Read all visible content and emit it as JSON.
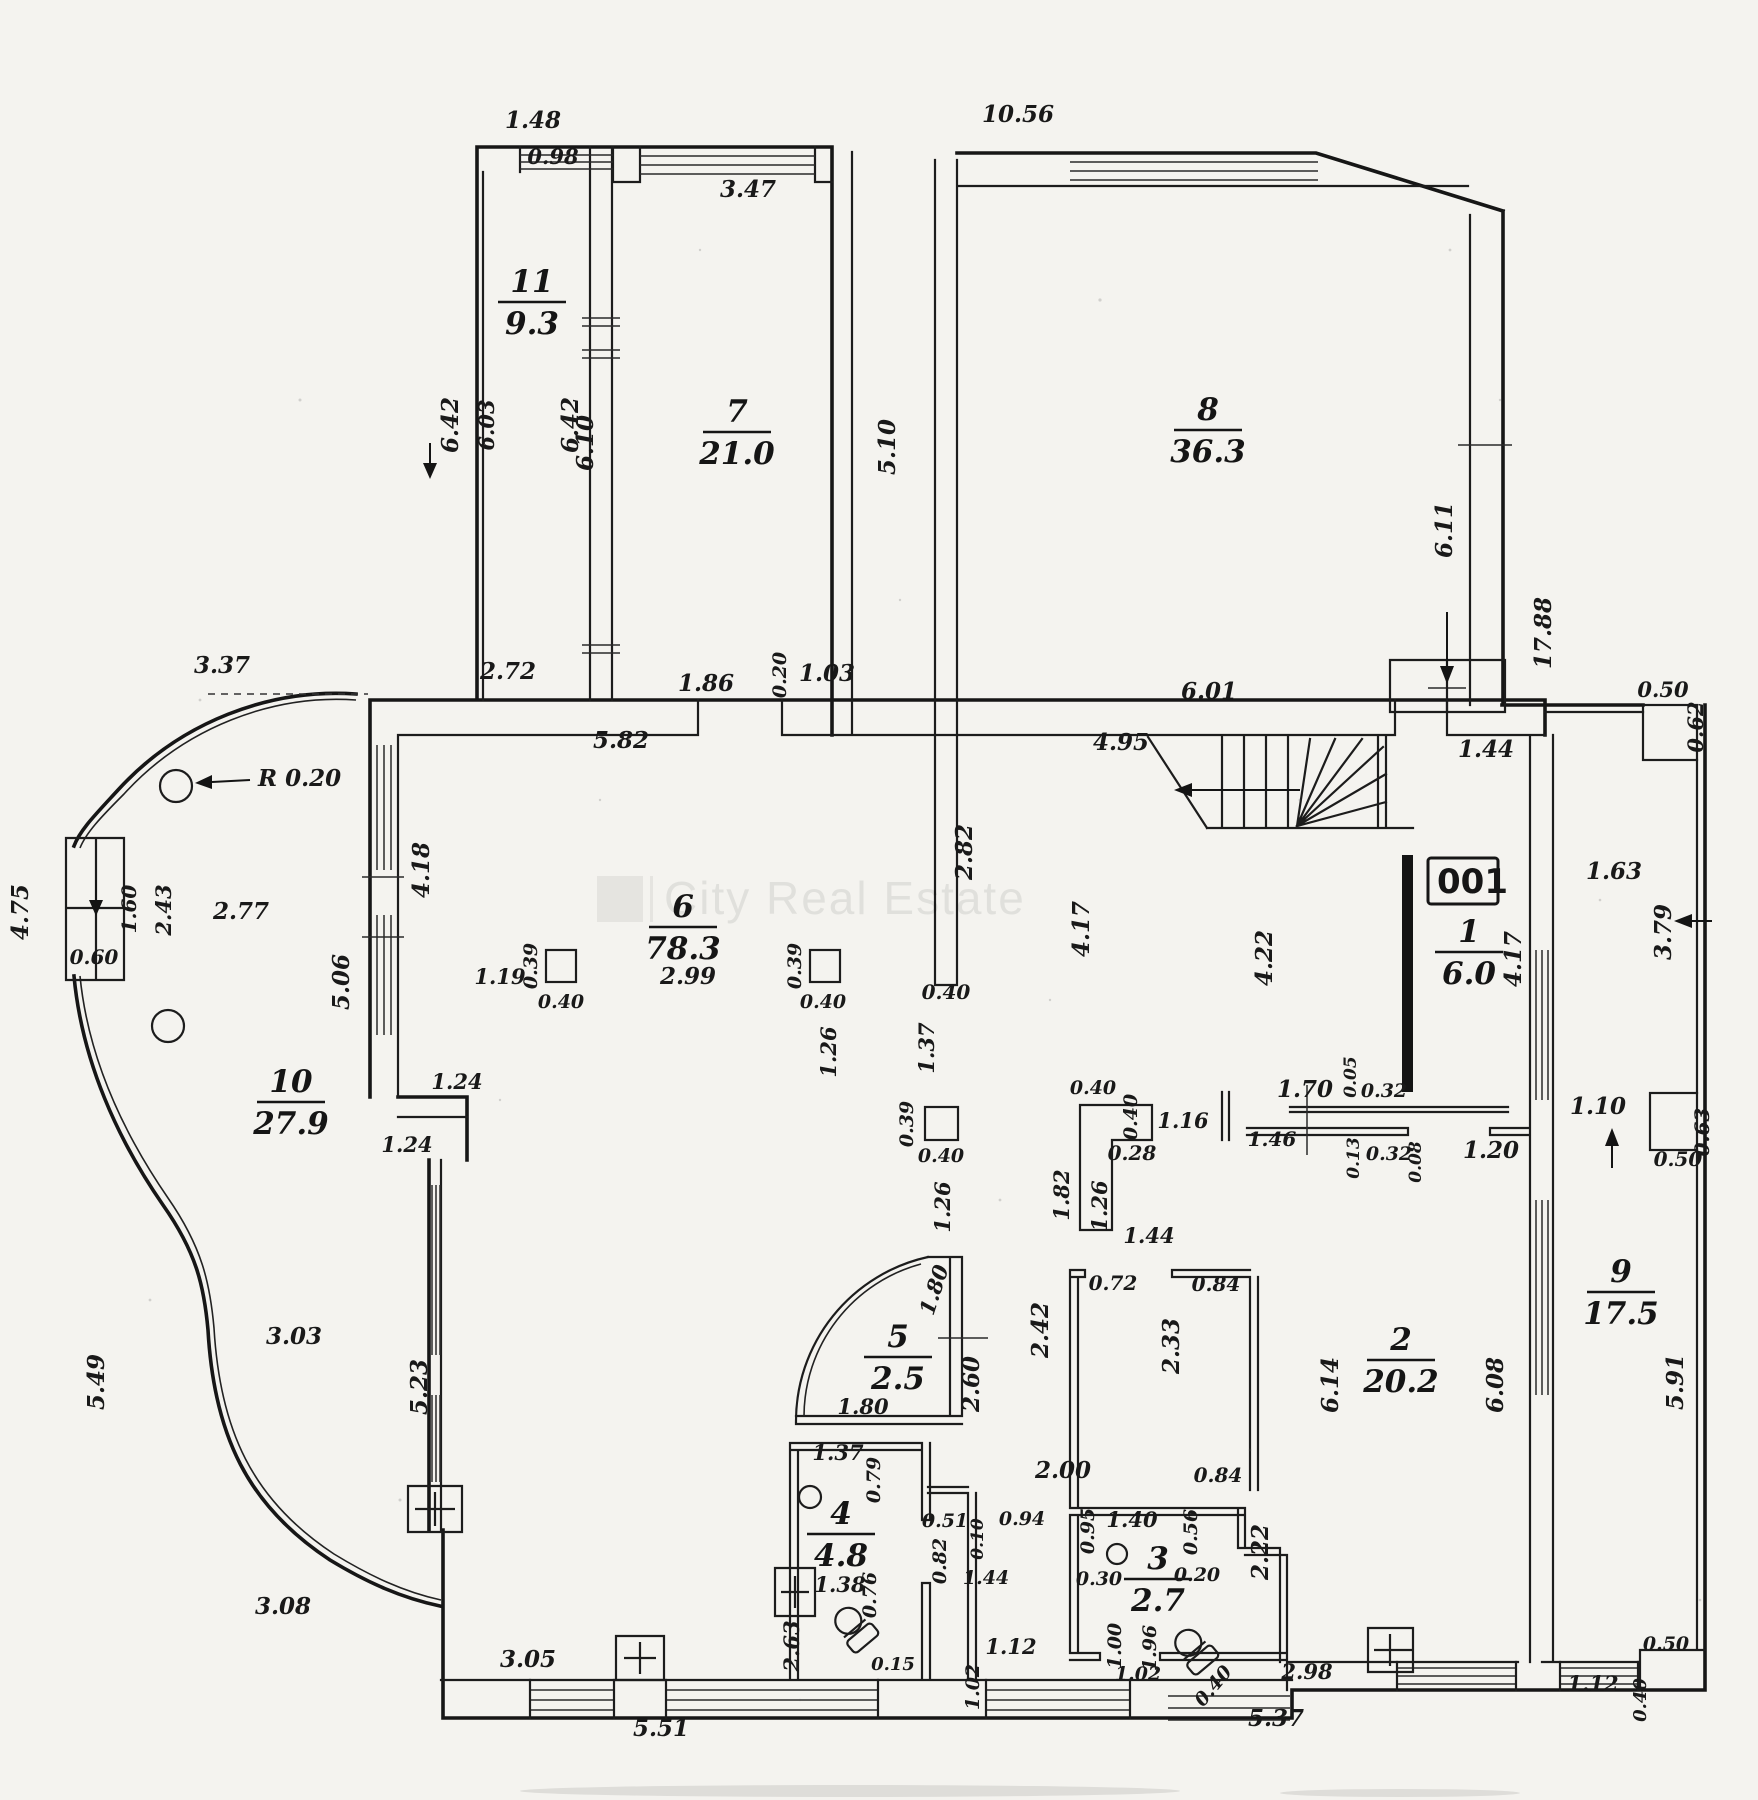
{
  "watermark": {
    "text": "City Real Estate"
  },
  "badge": "001",
  "radius_label": "R 0.20",
  "rooms": [
    {
      "num": "11",
      "area": "9.3",
      "x": 532,
      "y": 300
    },
    {
      "num": "7",
      "area": "21.0",
      "x": 737,
      "y": 430
    },
    {
      "num": "8",
      "area": "36.3",
      "x": 1208,
      "y": 428
    },
    {
      "num": "6",
      "area": "78.3",
      "x": 683,
      "y": 925
    },
    {
      "num": "10",
      "area": "27.9",
      "x": 291,
      "y": 1100
    },
    {
      "num": "1",
      "area": "6.0",
      "x": 1469,
      "y": 950
    },
    {
      "num": "5",
      "area": "2.5",
      "x": 898,
      "y": 1355
    },
    {
      "num": "4",
      "area": "4.8",
      "x": 841,
      "y": 1532
    },
    {
      "num": "3",
      "area": "2.7",
      "x": 1158,
      "y": 1577
    },
    {
      "num": "2",
      "area": "20.2",
      "x": 1401,
      "y": 1358
    },
    {
      "num": "9",
      "area": "17.5",
      "x": 1621,
      "y": 1290
    }
  ],
  "dims": [
    {
      "t": "1.48",
      "x": 533,
      "y": 128
    },
    {
      "t": "0.98",
      "x": 553,
      "y": 164,
      "s": 21
    },
    {
      "t": "3.47",
      "x": 748,
      "y": 197
    },
    {
      "t": "10.56",
      "x": 1018,
      "y": 122
    },
    {
      "t": "6.42",
      "x": 458,
      "y": 425,
      "r": -90
    },
    {
      "t": "6.03",
      "x": 494,
      "y": 425,
      "r": -90,
      "s": 21
    },
    {
      "t": "6.42",
      "x": 578,
      "y": 425,
      "r": -90
    },
    {
      "t": "6.10",
      "x": 593,
      "y": 443,
      "r": -90
    },
    {
      "t": "5.10",
      "x": 895,
      "y": 447,
      "r": -90
    },
    {
      "t": "6.11",
      "x": 1452,
      "y": 530,
      "r": -90
    },
    {
      "t": "17.88",
      "x": 1551,
      "y": 633,
      "r": -90
    },
    {
      "t": "2.72",
      "x": 508,
      "y": 679
    },
    {
      "t": "1.86",
      "x": 706,
      "y": 691
    },
    {
      "t": "0.20",
      "x": 786,
      "y": 675,
      "r": -90,
      "s": 19
    },
    {
      "t": "1.03",
      "x": 827,
      "y": 681
    },
    {
      "t": "5.82",
      "x": 621,
      "y": 748
    },
    {
      "t": "6.01",
      "x": 1209,
      "y": 699
    },
    {
      "t": "4.95",
      "x": 1121,
      "y": 750
    },
    {
      "t": "1.44",
      "x": 1486,
      "y": 757
    },
    {
      "t": "0.50",
      "x": 1663,
      "y": 697,
      "s": 21
    },
    {
      "t": "0.62",
      "x": 1703,
      "y": 727,
      "r": -90,
      "s": 21
    },
    {
      "t": "2.82",
      "x": 972,
      "y": 852,
      "r": -90
    },
    {
      "t": "1.63",
      "x": 1614,
      "y": 879
    },
    {
      "t": "3.79",
      "x": 1671,
      "y": 932,
      "r": -90
    },
    {
      "t": "4.17",
      "x": 1089,
      "y": 929,
      "r": -90
    },
    {
      "t": "4.22",
      "x": 1272,
      "y": 958,
      "r": -90
    },
    {
      "t": "4.17",
      "x": 1521,
      "y": 959,
      "r": -90
    },
    {
      "t": "3.37",
      "x": 222,
      "y": 673
    },
    {
      "t": "4.75",
      "x": 28,
      "y": 912,
      "r": -90
    },
    {
      "t": "1.60",
      "x": 136,
      "y": 909,
      "r": -90,
      "s": 20
    },
    {
      "t": "2.43",
      "x": 171,
      "y": 910,
      "r": -90,
      "s": 21
    },
    {
      "t": "2.77",
      "x": 241,
      "y": 919
    },
    {
      "t": "0.60",
      "x": 94,
      "y": 964,
      "s": 20
    },
    {
      "t": "5.06",
      "x": 349,
      "y": 982,
      "r": -90
    },
    {
      "t": "4.18",
      "x": 429,
      "y": 870,
      "r": -90
    },
    {
      "t": "1.24",
      "x": 457,
      "y": 1089,
      "s": 21
    },
    {
      "t": "1.24",
      "x": 407,
      "y": 1152,
      "s": 21
    },
    {
      "t": "0.40",
      "x": 946,
      "y": 999,
      "s": 20
    },
    {
      "t": "1.37",
      "x": 934,
      "y": 1048,
      "r": -90,
      "s": 21
    },
    {
      "t": "0.39",
      "x": 913,
      "y": 1124,
      "r": -90,
      "s": 19
    },
    {
      "t": "0.40",
      "x": 941,
      "y": 1162,
      "s": 19
    },
    {
      "t": "1.26",
      "x": 950,
      "y": 1207,
      "r": -90,
      "s": 21
    },
    {
      "t": "1.19",
      "x": 500,
      "y": 984,
      "s": 21
    },
    {
      "t": "0.39",
      "x": 537,
      "y": 966,
      "r": -90,
      "s": 19
    },
    {
      "t": "0.40",
      "x": 561,
      "y": 1008,
      "s": 19
    },
    {
      "t": "2.99",
      "x": 688,
      "y": 984
    },
    {
      "t": "0.39",
      "x": 801,
      "y": 966,
      "r": -90,
      "s": 19
    },
    {
      "t": "0.40",
      "x": 823,
      "y": 1008,
      "s": 19
    },
    {
      "t": "1.26",
      "x": 836,
      "y": 1052,
      "r": -90,
      "s": 21
    },
    {
      "t": "0.40",
      "x": 1093,
      "y": 1094,
      "s": 19
    },
    {
      "t": "0.40",
      "x": 1137,
      "y": 1117,
      "r": -90,
      "s": 19
    },
    {
      "t": "0.28",
      "x": 1132,
      "y": 1160,
      "s": 20
    },
    {
      "t": "1.16",
      "x": 1183,
      "y": 1128,
      "s": 21
    },
    {
      "t": "1.82",
      "x": 1069,
      "y": 1195,
      "r": -90,
      "s": 21
    },
    {
      "t": "1.26",
      "x": 1107,
      "y": 1206,
      "r": -90,
      "s": 21
    },
    {
      "t": "1.44",
      "x": 1149,
      "y": 1243,
      "s": 21
    },
    {
      "t": "1.70",
      "x": 1305,
      "y": 1097
    },
    {
      "t": "0.05",
      "x": 1356,
      "y": 1077,
      "r": -90,
      "s": 17
    },
    {
      "t": "0.32",
      "x": 1384,
      "y": 1097,
      "s": 19
    },
    {
      "t": "1.46",
      "x": 1272,
      "y": 1146,
      "s": 20
    },
    {
      "t": "0.13",
      "x": 1359,
      "y": 1158,
      "r": -90,
      "s": 17
    },
    {
      "t": "0.32",
      "x": 1389,
      "y": 1160,
      "s": 19
    },
    {
      "t": "0.08",
      "x": 1421,
      "y": 1162,
      "r": -90,
      "s": 17
    },
    {
      "t": "1.20",
      "x": 1491,
      "y": 1158
    },
    {
      "t": "1.10",
      "x": 1598,
      "y": 1114
    },
    {
      "t": "0.63",
      "x": 1709,
      "y": 1132,
      "r": -90,
      "s": 20
    },
    {
      "t": "0.50",
      "x": 1678,
      "y": 1166,
      "s": 20
    },
    {
      "t": "0.72",
      "x": 1113,
      "y": 1290,
      "s": 20
    },
    {
      "t": "0.84",
      "x": 1216,
      "y": 1291,
      "s": 20
    },
    {
      "t": "2.42",
      "x": 1048,
      "y": 1330,
      "r": -90
    },
    {
      "t": "2.33",
      "x": 1179,
      "y": 1346,
      "r": -90
    },
    {
      "t": "6.14",
      "x": 1338,
      "y": 1385,
      "r": -90
    },
    {
      "t": "6.08",
      "x": 1503,
      "y": 1385,
      "r": -90
    },
    {
      "t": "5.91",
      "x": 1683,
      "y": 1382,
      "r": -90
    },
    {
      "t": "2.22",
      "x": 1268,
      "y": 1552,
      "r": -90
    },
    {
      "t": "0.84",
      "x": 1218,
      "y": 1482,
      "s": 20
    },
    {
      "t": "1.40",
      "x": 1132,
      "y": 1527,
      "s": 21
    },
    {
      "t": "0.95",
      "x": 1094,
      "y": 1531,
      "r": -90,
      "s": 19
    },
    {
      "t": "0.56",
      "x": 1197,
      "y": 1532,
      "r": -90,
      "s": 19
    },
    {
      "t": "0.30",
      "x": 1099,
      "y": 1585,
      "s": 19
    },
    {
      "t": "0.20",
      "x": 1197,
      "y": 1581,
      "s": 19
    },
    {
      "t": "1.00",
      "x": 1121,
      "y": 1646,
      "r": -90,
      "s": 19
    },
    {
      "t": "1.96",
      "x": 1156,
      "y": 1648,
      "r": -90,
      "s": 19
    },
    {
      "t": "1.02",
      "x": 1138,
      "y": 1680,
      "s": 19
    },
    {
      "t": "0.40",
      "x": 1218,
      "y": 1690,
      "r": -50,
      "s": 19
    },
    {
      "t": "2.98",
      "x": 1307,
      "y": 1679,
      "s": 21
    },
    {
      "t": "5.37",
      "x": 1276,
      "y": 1726
    },
    {
      "t": "1.12",
      "x": 1593,
      "y": 1691,
      "s": 21
    },
    {
      "t": "0.40",
      "x": 1646,
      "y": 1700,
      "r": -90,
      "s": 18
    },
    {
      "t": "0.50",
      "x": 1666,
      "y": 1650,
      "s": 19
    },
    {
      "t": "1.12",
      "x": 1011,
      "y": 1654,
      "s": 21
    },
    {
      "t": "1.02",
      "x": 979,
      "y": 1687,
      "r": -90,
      "s": 19
    },
    {
      "t": "5.51",
      "x": 661,
      "y": 1736
    },
    {
      "t": "3.05",
      "x": 528,
      "y": 1667
    },
    {
      "t": "3.08",
      "x": 283,
      "y": 1614
    },
    {
      "t": "3.03",
      "x": 294,
      "y": 1344
    },
    {
      "t": "5.49",
      "x": 104,
      "y": 1382,
      "r": -90
    },
    {
      "t": "5.23",
      "x": 427,
      "y": 1387,
      "r": -90
    },
    {
      "t": "1.80",
      "x": 941,
      "y": 1292,
      "r": -72,
      "s": 21
    },
    {
      "t": "2.60",
      "x": 979,
      "y": 1384,
      "r": -90
    },
    {
      "t": "1.80",
      "x": 863,
      "y": 1414,
      "s": 21
    },
    {
      "t": "1.37",
      "x": 838,
      "y": 1460,
      "s": 21
    },
    {
      "t": "0.79",
      "x": 880,
      "y": 1480,
      "r": -90,
      "s": 19
    },
    {
      "t": "0.51",
      "x": 945,
      "y": 1527,
      "s": 19
    },
    {
      "t": "0.10",
      "x": 983,
      "y": 1539,
      "r": -90,
      "s": 17
    },
    {
      "t": "0.94",
      "x": 1022,
      "y": 1525,
      "s": 19
    },
    {
      "t": "2.00",
      "x": 1063,
      "y": 1478
    },
    {
      "t": "0.82",
      "x": 946,
      "y": 1561,
      "r": -90,
      "s": 19
    },
    {
      "t": "1.44",
      "x": 986,
      "y": 1584,
      "s": 19
    },
    {
      "t": "1.38",
      "x": 840,
      "y": 1592,
      "s": 21
    },
    {
      "t": "0.76",
      "x": 876,
      "y": 1595,
      "r": -90,
      "s": 19
    },
    {
      "t": "2.63",
      "x": 799,
      "y": 1646,
      "r": -90,
      "s": 21
    },
    {
      "t": "0.15",
      "x": 893,
      "y": 1670,
      "s": 18
    }
  ]
}
